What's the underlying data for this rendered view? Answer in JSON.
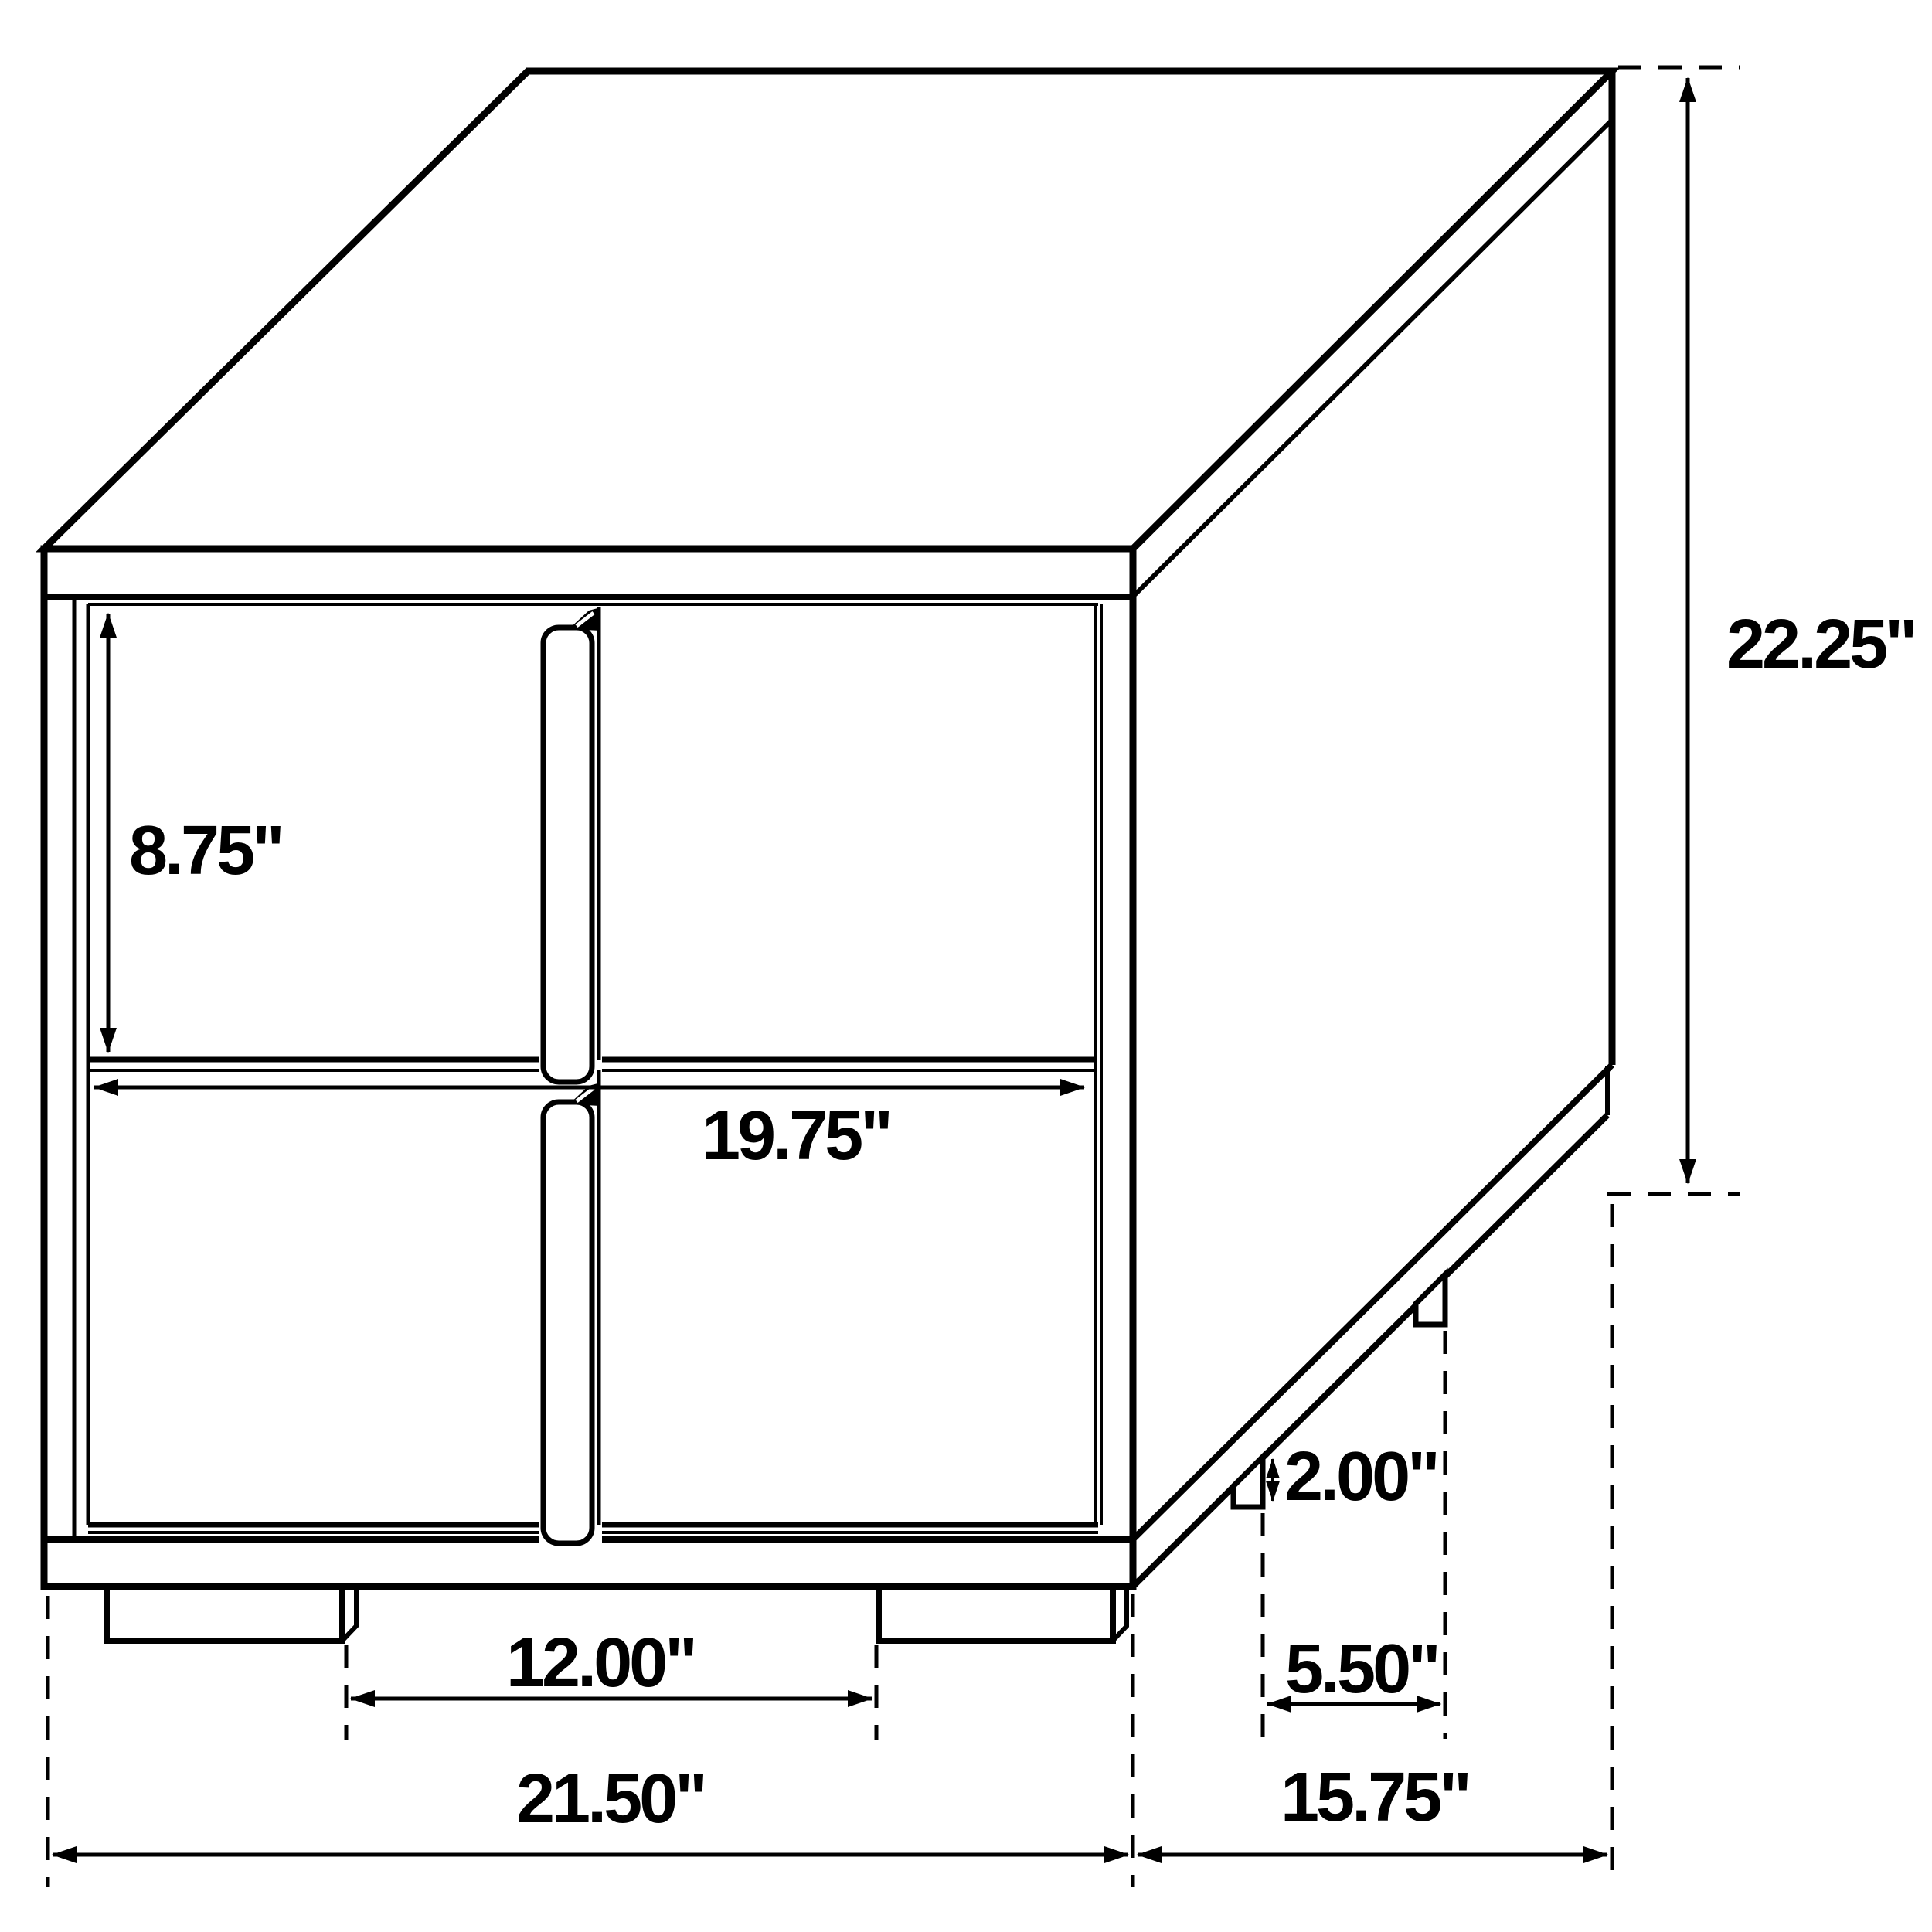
{
  "page": {
    "title": "Nightstand dimensioned line drawing",
    "background_color": "#ffffff",
    "line_color": "#000000"
  },
  "diagram": {
    "subject": "two-drawer nightstand, perspective technical drawing",
    "unit": "inches",
    "style": "black outline CAD dimension drawing"
  },
  "labels": {
    "drawer_height": "8.75\"",
    "drawer_width": "19.75\"",
    "overall_height": "22.25\"",
    "foot_height": "2.00\"",
    "side_foot_gap": "5.50\"",
    "front_foot_gap": "12.00\"",
    "overall_width": "21.50\"",
    "overall_depth": "15.75\""
  }
}
